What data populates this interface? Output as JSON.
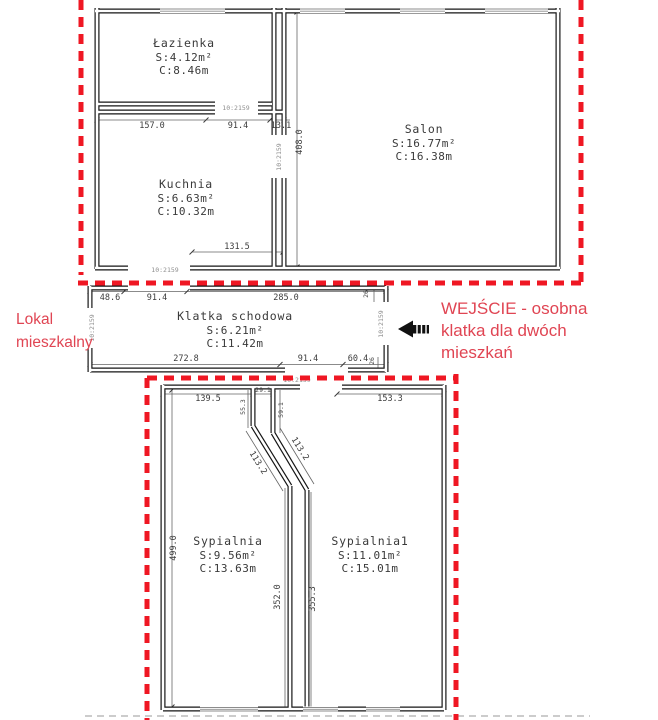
{
  "door_label": "10:2159",
  "rooms": [
    {
      "name": "Łazienka",
      "s": "S:4.12m²",
      "c": "C:8.46m"
    },
    {
      "name": "Kuchnia",
      "s": "S:6.63m²",
      "c": "C:10.32m"
    },
    {
      "name": "Salon",
      "s": "S:16.77m²",
      "c": "C:16.38m"
    },
    {
      "name": "Klatka schodowa",
      "s": "S:6.21m²",
      "c": "C:11.42m"
    },
    {
      "name": "Sypialnia",
      "s": "S:9.56m²",
      "c": "C:13.63m"
    },
    {
      "name": "Sypialnia1",
      "s": "S:11.01m²",
      "c": "C:15.01m"
    }
  ],
  "dims": [
    {
      "id": "bath-bottom-1",
      "t": "157.0"
    },
    {
      "id": "bath-bottom-2",
      "t": "91.4"
    },
    {
      "id": "bath-bottom-3",
      "t": "13.1"
    },
    {
      "id": "salon-height",
      "t": "408.0"
    },
    {
      "id": "kitchen-bottom",
      "t": "131.5"
    },
    {
      "id": "stair-top-1",
      "t": "48.6"
    },
    {
      "id": "stair-top-2",
      "t": "91.4"
    },
    {
      "id": "stair-top-3",
      "t": "285.0"
    },
    {
      "id": "stair-top-4",
      "t": "26"
    },
    {
      "id": "stair-bot-1",
      "t": "272.8"
    },
    {
      "id": "stair-bot-2",
      "t": "91.4"
    },
    {
      "id": "stair-bot-3",
      "t": "60.4"
    },
    {
      "id": "stair-bot-4",
      "t": "26"
    },
    {
      "id": "bed-top-1",
      "t": "139.5"
    },
    {
      "id": "bed-top-2",
      "t": "55.3"
    },
    {
      "id": "bed-top-3",
      "t": "29.1"
    },
    {
      "id": "bed-top-4",
      "t": "59.1"
    },
    {
      "id": "bed-top-5",
      "t": "153.3"
    },
    {
      "id": "bed-diag-1",
      "t": "113.2"
    },
    {
      "id": "bed-diag-2",
      "t": "113.2"
    },
    {
      "id": "bed-vert-1",
      "t": "499.0"
    },
    {
      "id": "bed-vert-2",
      "t": "352.0"
    },
    {
      "id": "bed-vert-3",
      "t": "355.3"
    }
  ],
  "notes": {
    "unit": [
      "Lokal",
      "mieszkalny"
    ],
    "entrance": [
      "WEJŚCIE - osobna",
      "klatka dla dwóch",
      "mieszkań"
    ]
  },
  "colors": {
    "boundary": "#ef1723",
    "annotation": "#e04553",
    "wall": "#161616"
  }
}
